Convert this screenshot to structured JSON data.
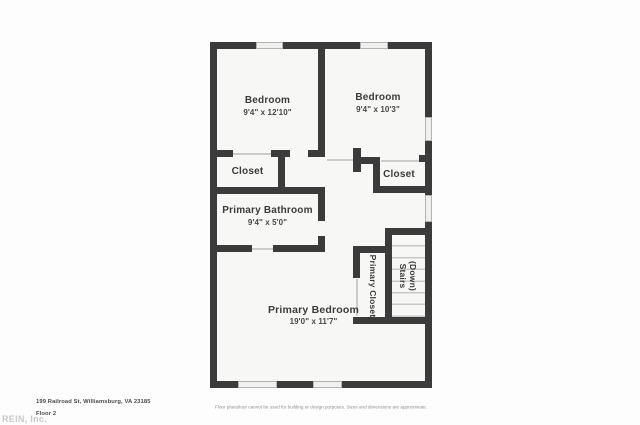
{
  "colors": {
    "wall": "#3b3b3b",
    "floor": "#f7f7f5",
    "page_background": "#fdfdfd",
    "window_fill": "#f0f0ee",
    "window_line": "#b3b3b3",
    "door_line": "#cccccc",
    "stair_tread_line": "#c9c9c9",
    "label_text": "#3b3b3b",
    "footer_text": "#4b4b4b",
    "watermark_text": "#cacaca",
    "disclaimer_text": "#8f8f8f"
  },
  "rooms": {
    "bedroom1": {
      "name": "Bedroom",
      "dims": "9'4\" x 12'10\""
    },
    "bedroom2": {
      "name": "Bedroom",
      "dims": "9'4\" x 10'3\""
    },
    "closet1": {
      "name": "Closet"
    },
    "closet2": {
      "name": "Closet"
    },
    "primary_bathroom": {
      "name": "Primary Bathroom",
      "dims": "9'4\" x 5'0\""
    },
    "primary_bedroom": {
      "name": "Primary Bedroom",
      "dims": "19'0\" x 11'7\""
    },
    "primary_closet": {
      "name": "Primary Closet"
    },
    "stairs": {
      "name": "Stairs",
      "sub": "(Down)"
    }
  },
  "footer": {
    "address": "199 Railroad St, Williamsburg, VA 23185",
    "floor": "Floor 2",
    "watermark": "REIN, Inc.",
    "disclaimer": "Floor plans/tour cannot be used for building or design purposes. Sizes and dimensions are approximate."
  }
}
